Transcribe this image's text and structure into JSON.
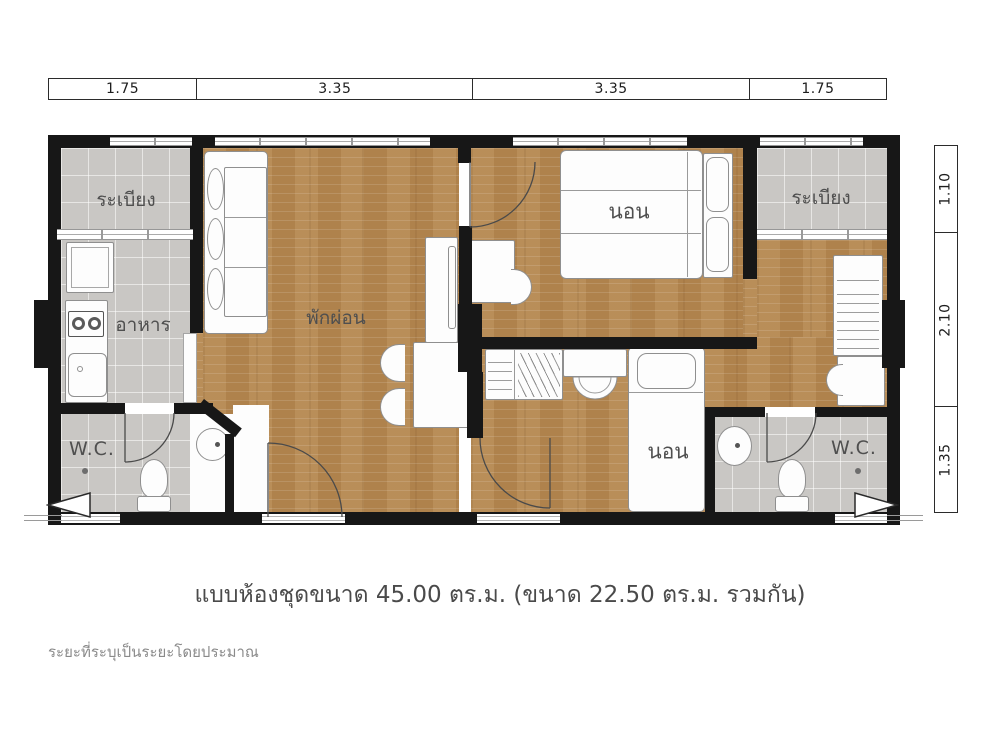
{
  "caption": "แบบห้องชุดขนาด 45.00 ตร.ม. (ขนาด 22.50 ตร.ม. รวมกัน)",
  "footnote": "ระยะที่ระบุเป็นระยะโดยประมาณ",
  "dims": {
    "top": [
      "1.75",
      "3.35",
      "3.35",
      "1.75"
    ],
    "right": [
      "1.10",
      "2.10",
      "1.35"
    ]
  },
  "rooms": {
    "balcony_left": "ระเบียง",
    "balcony_right": "ระเบียง",
    "dining": "อาหาร",
    "living": "พักผ่อน",
    "bedroom_top": "นอน",
    "bedroom_bottom": "นอน",
    "wc_left": "W.C.",
    "wc_right": "W.C."
  },
  "colors": {
    "wood_floor": "#b5874f",
    "tile_floor": "#c9c7c4",
    "wall": "#171717",
    "label_text": "#4f4f4f"
  }
}
